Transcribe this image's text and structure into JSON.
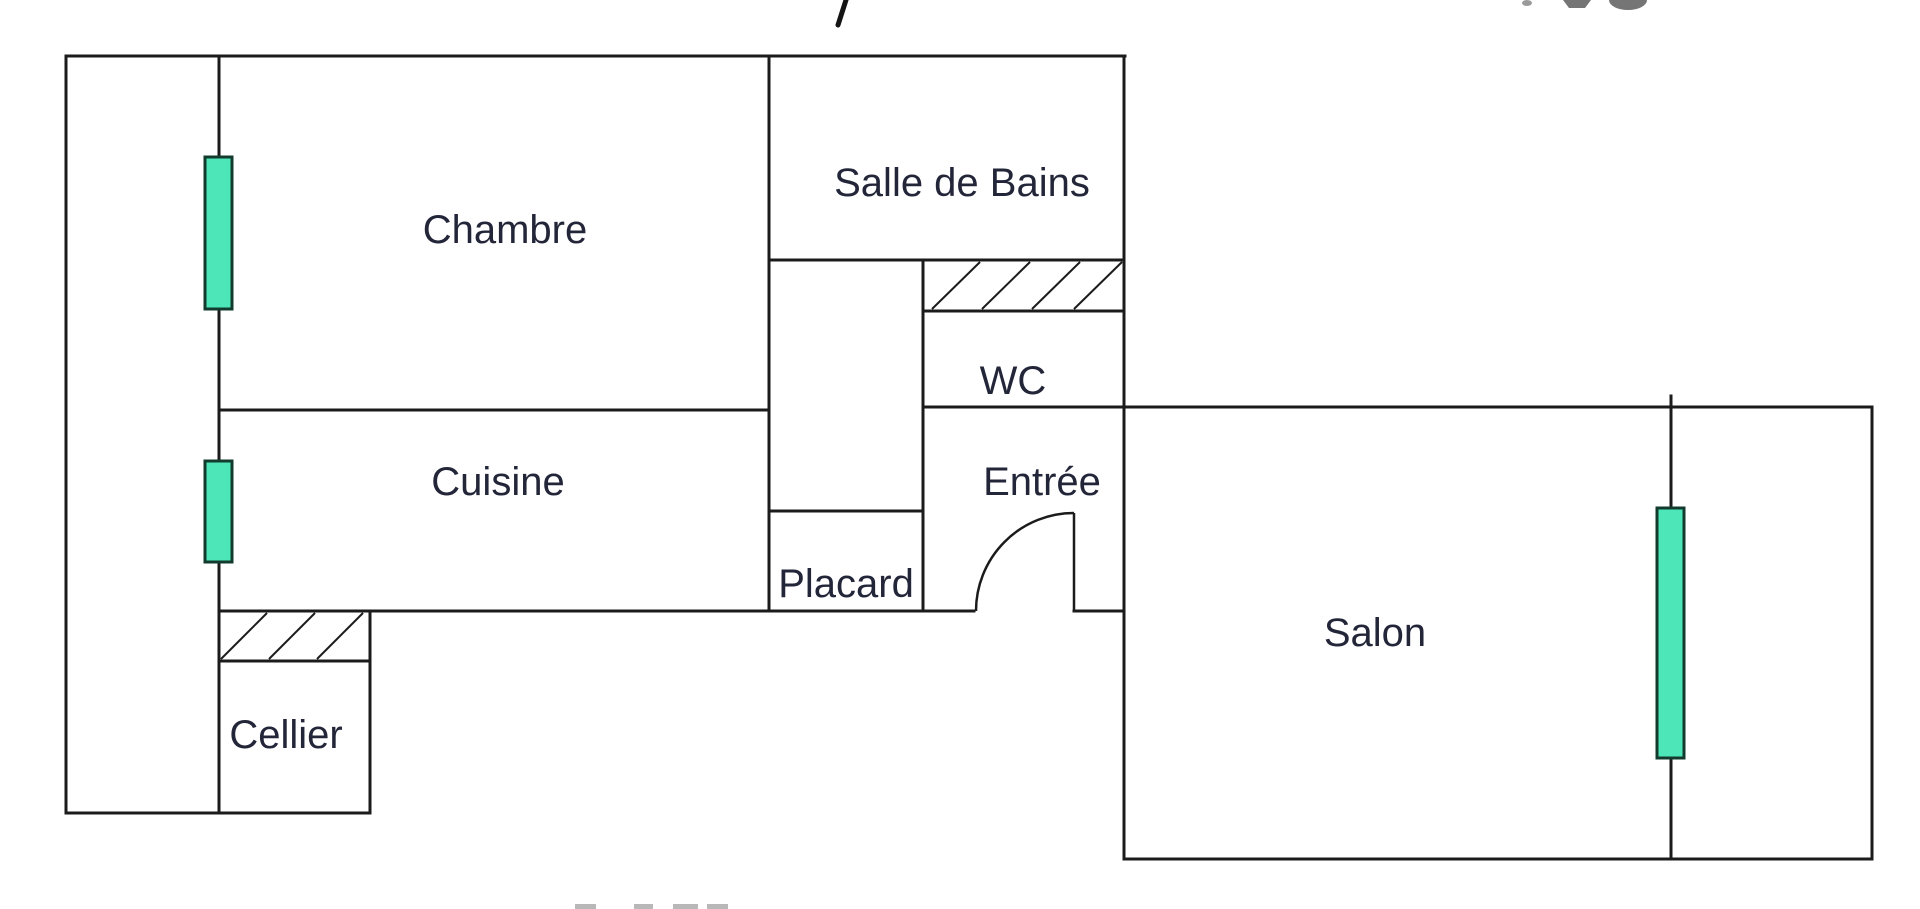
{
  "page": {
    "background": "#ffffff"
  },
  "colors": {
    "wall": "#1b1b1b",
    "label": "#232639",
    "window_fill": "#4de6b8",
    "window_stroke": "#123b2e",
    "watermark_gray": "#757575"
  },
  "rooms": {
    "chambre": {
      "label": "Chambre"
    },
    "salle_de_bains": {
      "label": "Salle de Bains"
    },
    "wc": {
      "label": "WC"
    },
    "cuisine": {
      "label": "Cuisine"
    },
    "entree": {
      "label": "Entrée"
    },
    "placard": {
      "label": "Placard"
    },
    "cellier": {
      "label": "Cellier"
    },
    "salon": {
      "label": "Salon"
    }
  }
}
